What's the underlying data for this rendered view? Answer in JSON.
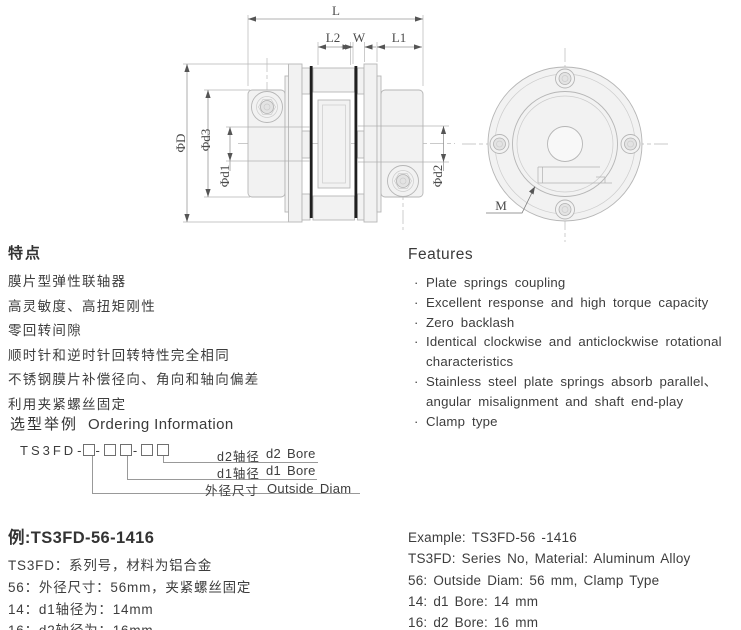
{
  "drawing": {
    "labels": {
      "L": "L",
      "L2": "L2",
      "W": "W",
      "L1": "L1",
      "phiD": "ΦD",
      "phid3": "Φd3",
      "phid1": "Φd1",
      "phid2": "Φd2",
      "M": "M"
    },
    "colors": {
      "part_fill": "#f2f2f2",
      "part_line": "#b6b6b6",
      "diaphragm": "#1f1f1f",
      "dim_line": "#999999"
    }
  },
  "features_cn": {
    "title": "特点",
    "items": [
      "膜片型弹性联轴器",
      "高灵敏度、高扭矩刚性",
      "零回转间隙",
      "顺时针和逆时针回转特性完全相同",
      "不锈钢膜片补偿径向、角向和轴向偏差",
      "利用夹紧螺丝固定"
    ]
  },
  "features_en": {
    "title": "Features",
    "lines": [
      {
        "bullet": "·",
        "text": "Plate springs coupling"
      },
      {
        "bullet": "·",
        "text": "Excellent response and high torque capacity"
      },
      {
        "bullet": "·",
        "text": "Zero backlash"
      },
      {
        "bullet": "·",
        "text": "Identical clockwise and anticlockwise rotational"
      },
      {
        "bullet": "",
        "text": "characteristics"
      },
      {
        "bullet": "·",
        "text": "Stainless steel plate springs absorb parallel、"
      },
      {
        "bullet": "",
        "text": "angular misalignment and shaft end-play"
      },
      {
        "bullet": "·",
        "text": "Clamp type"
      }
    ]
  },
  "ordering": {
    "title_cn": "选型举例",
    "title_en": "Ordering Information",
    "code_prefix": "TS3FD",
    "dash": "-",
    "rows": [
      {
        "cn": "d2轴径",
        "en": "d2 Bore"
      },
      {
        "cn": "d1轴径",
        "en": "d1 Bore"
      },
      {
        "cn": "外径尺寸",
        "en": "Outside Diam"
      }
    ]
  },
  "example_cn": {
    "title": "例:TS3FD-56-1416",
    "lines": [
      "TS3FD：系列号，材料为铝合金",
      "56：外径尺寸：56mm，夹紧螺丝固定",
      "14：d1轴径为：14mm",
      "16：d2轴径为：16mm"
    ]
  },
  "example_en": {
    "lines": [
      "Example: TS3FD-56 -1416",
      "TS3FD: Series No, Material: Aluminum Alloy",
      "56: Outside Diam: 56 mm, Clamp Type",
      "14: d1 Bore: 14 mm",
      "16: d2 Bore: 16 mm"
    ]
  }
}
